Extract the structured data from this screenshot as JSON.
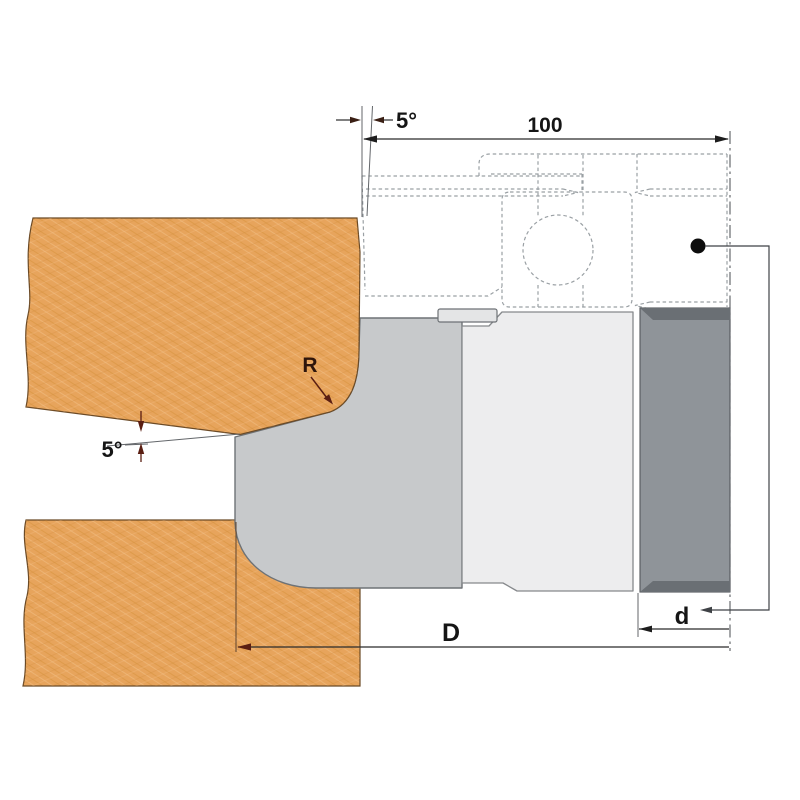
{
  "drawing": {
    "description": "Cross-section technical drawing of a roundover cutter head machining two wooden boards",
    "labels": {
      "shear_angle": "5°",
      "cutting_width": "100",
      "profile_radius": "R",
      "clearance_angle": "5°",
      "outer_diameter": "D",
      "bore_diameter": "d"
    },
    "colors": {
      "wood_base": "#e7a45c",
      "wood_grain_dark": "#d6913d",
      "wood_grain_light": "#f2bd80",
      "wood_outline": "#6b4a26",
      "knife_profile": "#c7c9cb",
      "body_face": "#ededee",
      "tab_face": "#e4e5e6",
      "hub": "#8f9499",
      "hub_band": "#6a6f74",
      "solid_outline": "#6e7276",
      "hidden_line": "#9aa0a4",
      "dim_line": "#2b2b2b",
      "dim_text": "#151515",
      "accent_arrow": "#5a1e12",
      "centerline": "#5a5e62",
      "dot": "#0d0d0d"
    }
  }
}
